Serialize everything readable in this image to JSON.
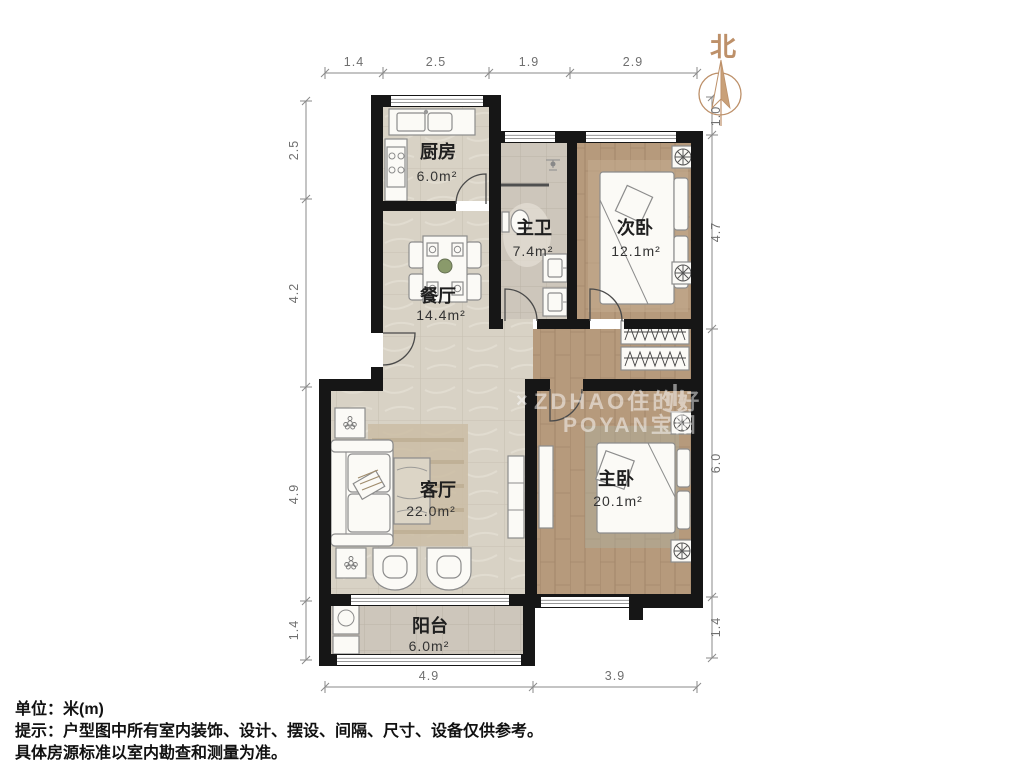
{
  "compass": {
    "north_label": "北"
  },
  "rooms": [
    {
      "name": "厨房",
      "area": "6.0m²"
    },
    {
      "name": "主卫",
      "area": "7.4m²"
    },
    {
      "name": "次卧",
      "area": "12.1m²"
    },
    {
      "name": "餐厅",
      "area": "14.4m²"
    },
    {
      "name": "客厅",
      "area": "22.0m²"
    },
    {
      "name": "主卧",
      "area": "20.1m²"
    },
    {
      "name": "阳台",
      "area": "6.0m²"
    }
  ],
  "dimensions": {
    "top": [
      "1.4",
      "2.5",
      "1.9",
      "2.9"
    ],
    "left": [
      "2.5",
      "4.2",
      "4.9",
      "1.4"
    ],
    "right": [
      "1.0",
      "4.7",
      "6.0",
      "1.4"
    ],
    "bottom": [
      "4.9",
      "3.9"
    ]
  },
  "watermark": {
    "separator": "×",
    "brand1": "ZDHAO住的好",
    "brand2": "POYAN宝阳"
  },
  "footer": {
    "line1": "单位：米(m)",
    "line2": "提示：户型图中所有室内装饰、设计、摆设、间隔、尺寸、设备仅供参考。",
    "line3": "具体房源标准以室内勘查和测量为准。"
  },
  "colors": {
    "wall": "#161616",
    "tile_floor": "#d8d2c5",
    "bath_floor": "#cdc6bb",
    "wood_floor": "#b69a7c",
    "north_accent": "#bd9069"
  }
}
